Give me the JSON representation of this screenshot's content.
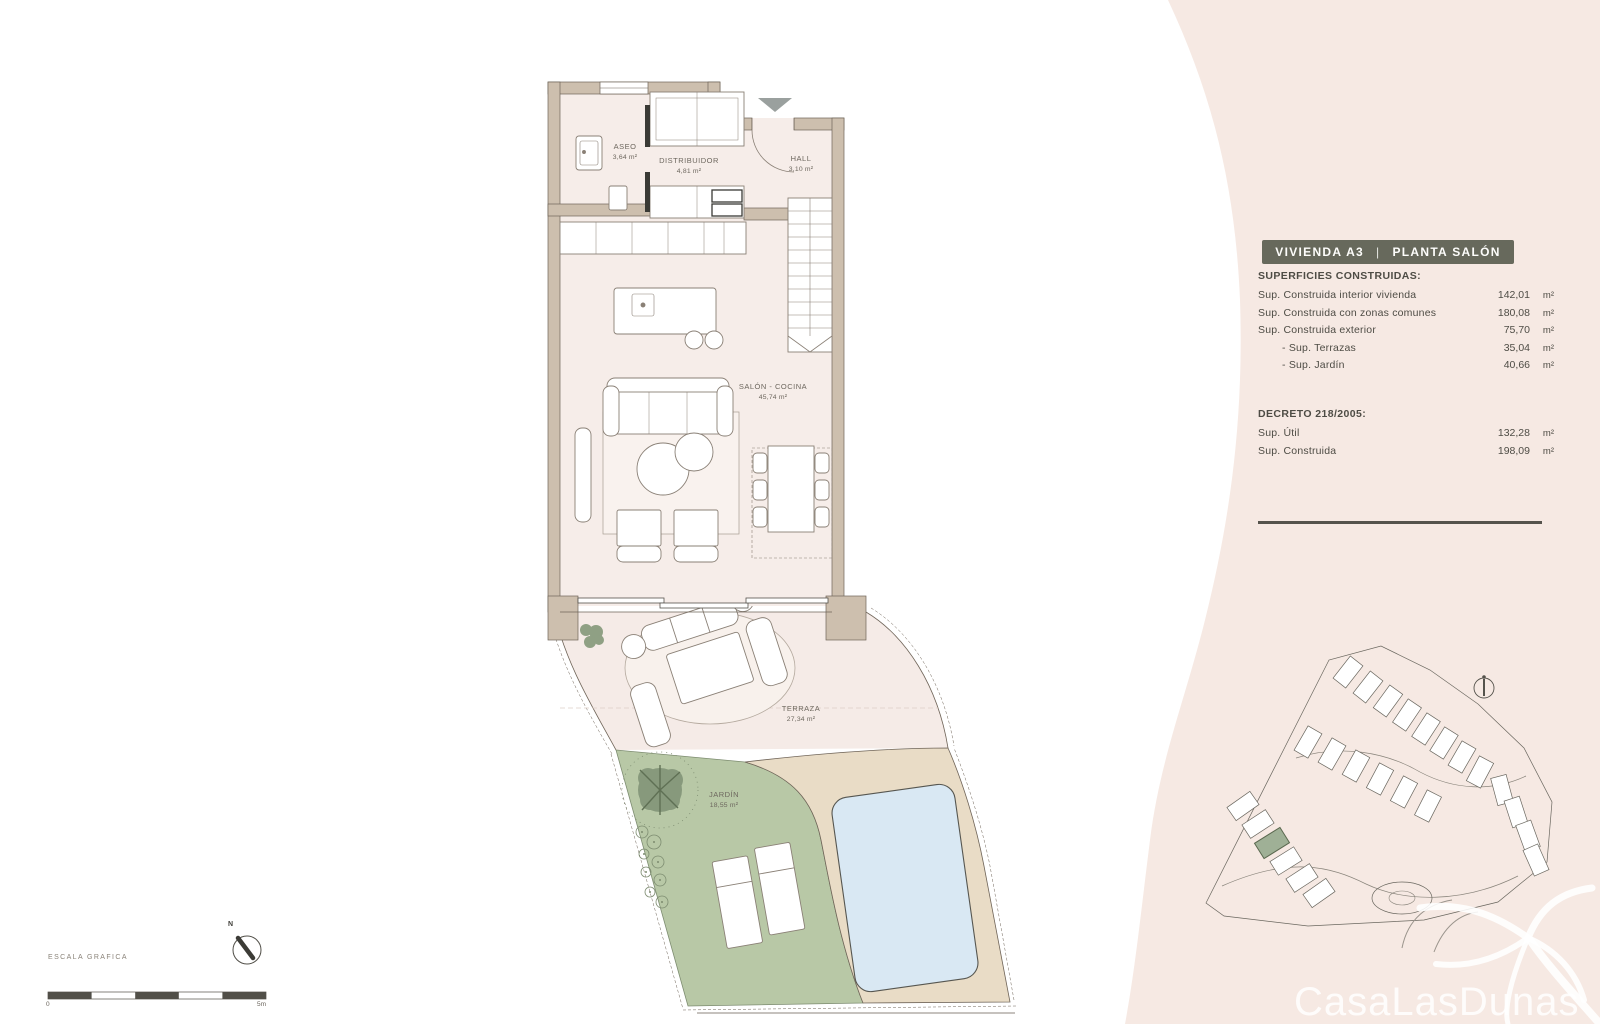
{
  "panel": {
    "title": {
      "left": "VIVIENDA A3",
      "sep": "|",
      "right": "PLANTA SALÓN"
    },
    "superficies_heading": "SUPERFICIES CONSTRUIDAS:",
    "rows": [
      {
        "label": "Sup. Construida interior vivienda",
        "value": "142,01",
        "unit": "m²"
      },
      {
        "label": "Sup. Construida con zonas comunes",
        "value": "180,08",
        "unit": "m²"
      },
      {
        "label": "Sup. Construida exterior",
        "value": "75,70",
        "unit": "m²"
      },
      {
        "label": "- Sup. Terrazas",
        "value": "35,04",
        "unit": "m²"
      },
      {
        "label": "- Sup. Jardín",
        "value": "40,66",
        "unit": "m²"
      }
    ],
    "decreto_heading": "DECRETO 218/2005:",
    "decreto_rows": [
      {
        "label": "Sup. Útil",
        "value": "132,28",
        "unit": "m²"
      },
      {
        "label": "Sup. Construida",
        "value": "198,09",
        "unit": "m²"
      }
    ]
  },
  "plan": {
    "rooms": [
      {
        "name": "ASEO",
        "area": "3,64 m²"
      },
      {
        "name": "DISTRIBUIDOR",
        "area": "4,81 m²"
      },
      {
        "name": "HALL",
        "area": "3,10 m²"
      },
      {
        "name": "SALÓN - COCINA",
        "area": "45,74 m²"
      },
      {
        "name": "TERRAZA",
        "area": "27,34 m²"
      },
      {
        "name": "JARDÍN",
        "area": "18,55 m²"
      }
    ]
  },
  "scale_bar": {
    "title": "ESCALA GRAFICA",
    "start": "0",
    "end": "5m"
  },
  "compass": {
    "label": "N"
  },
  "logo": {
    "text": "CasaLasDunas"
  },
  "colors": {
    "panel_pink": "#f6e9e3",
    "title_bar": "#67695c",
    "wall": "#cdbfae",
    "garden_green": "#b8c8a6",
    "deck_tan": "#e9dcc6",
    "pool_blue": "#d9e8f3"
  }
}
